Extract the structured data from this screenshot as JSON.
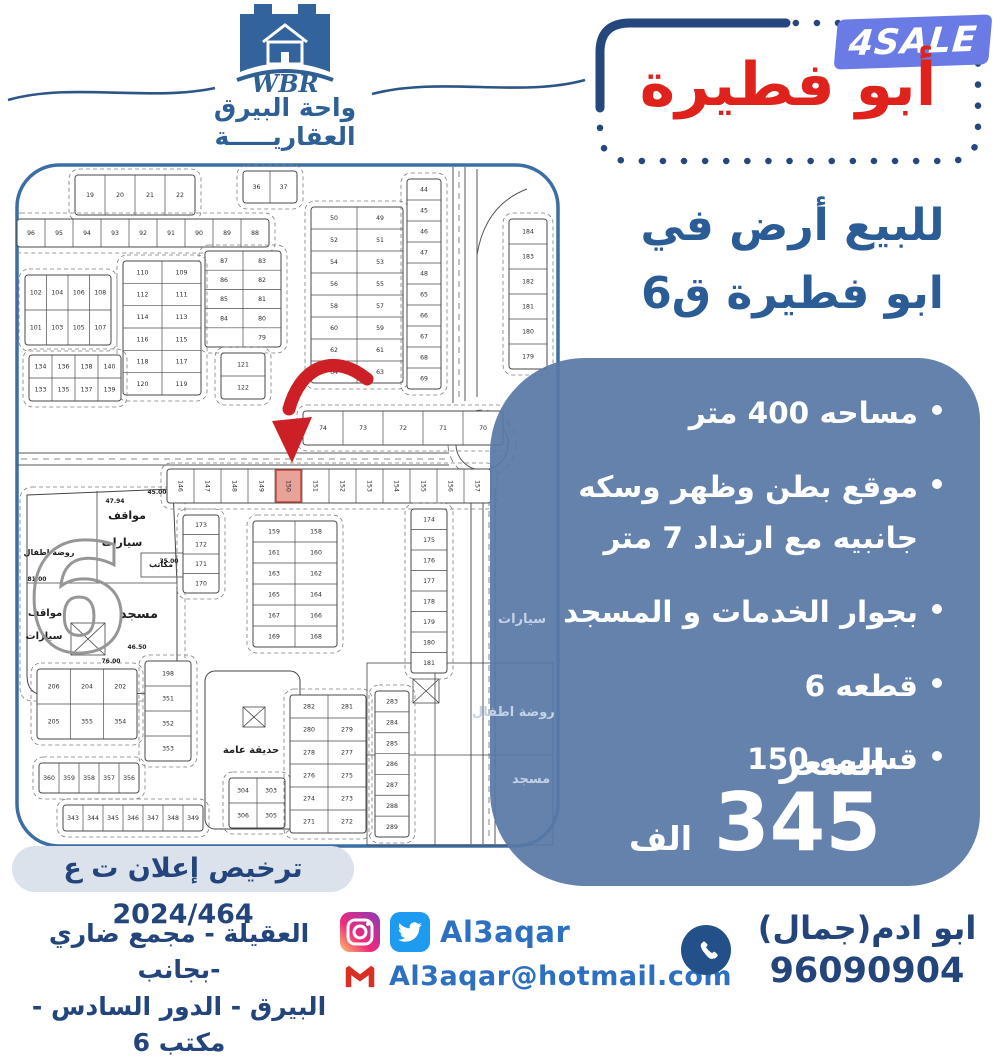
{
  "logo": {
    "wbr": "WBR",
    "line1": "واحة البيرق",
    "line2": "العقاريـــــة"
  },
  "badge": {
    "text": "4SALE"
  },
  "title": {
    "text": "أبو فطيرة"
  },
  "heading": {
    "line1": "للبيع أرض في",
    "line2": "ابو فطيرة ق6"
  },
  "details": {
    "bullets": [
      "مساحه 400 متر",
      "موقع بطن وظهر وسكه جانبيه مع ارتداد 7 متر",
      "بجوار الخدمات و المسجد",
      "قطعه 6",
      "قسيمه 150"
    ],
    "price_label": "السعر",
    "price_value": "345",
    "price_unit": "الف"
  },
  "license": {
    "text": "ترخيص إعلان ت ع 2024/464"
  },
  "footer": {
    "address1": "العقيلة - مجمع ضاري -بجانب",
    "address2": "البيرق - الدور السادس - مكتب 6",
    "handle": "Al3aqar",
    "email": "Al3aqar@hotmail.com",
    "agent": "ابو ادم(جمال)",
    "phone": "96090904"
  },
  "colors": {
    "navy": "#26477e",
    "red_title": "#df231c",
    "panel_blue": "#5879a6",
    "badge_bg": "#6a7be6",
    "link_blue": "#2d6fc0",
    "arrow_red": "#cc2026",
    "highlight_plot": "#e7a29a"
  },
  "map": {
    "highlight": "150",
    "blocks": [
      {
        "x": 60,
        "y": 12,
        "w": 120,
        "h": 40,
        "r": 1,
        "c": 4,
        "n": [
          "19",
          "20",
          "21",
          "22"
        ]
      },
      {
        "x": 2,
        "y": 56,
        "w": 252,
        "h": 28,
        "r": 1,
        "c": 9,
        "n": [
          "96",
          "95",
          "94",
          "93",
          "92",
          "91",
          "90",
          "89",
          "88"
        ]
      },
      {
        "x": 190,
        "y": 88,
        "w": 76,
        "h": 96,
        "r": 5,
        "c": 2,
        "n": [
          "87",
          "83",
          "86",
          "82",
          "85",
          "81",
          "84",
          "80",
          "",
          "79"
        ]
      },
      {
        "x": 228,
        "y": 8,
        "w": 54,
        "h": 32,
        "r": 1,
        "c": 2,
        "n": [
          "36",
          "37"
        ]
      },
      {
        "x": 10,
        "y": 112,
        "w": 86,
        "h": 70,
        "r": 2,
        "c": 4,
        "n": [
          "102",
          "104",
          "106",
          "108",
          "101",
          "103",
          "105",
          "107"
        ]
      },
      {
        "x": 108,
        "y": 98,
        "w": 78,
        "h": 134,
        "r": 6,
        "c": 2,
        "n": [
          "110",
          "109",
          "112",
          "111",
          "114",
          "113",
          "116",
          "115",
          "118",
          "117",
          "120",
          "119"
        ]
      },
      {
        "x": 206,
        "y": 190,
        "w": 44,
        "h": 46,
        "r": 2,
        "c": 1,
        "n": [
          "121",
          "122"
        ]
      },
      {
        "x": 14,
        "y": 192,
        "w": 92,
        "h": 46,
        "r": 2,
        "c": 4,
        "n": [
          "134",
          "136",
          "138",
          "140",
          "133",
          "135",
          "137",
          "139"
        ]
      },
      {
        "x": 296,
        "y": 44,
        "w": 92,
        "h": 176,
        "r": 8,
        "c": 2,
        "n": [
          "50",
          "49",
          "52",
          "51",
          "54",
          "53",
          "56",
          "55",
          "58",
          "57",
          "60",
          "59",
          "62",
          "61",
          "64",
          "63"
        ]
      },
      {
        "x": 392,
        "y": 16,
        "w": 34,
        "h": 210,
        "r": 10,
        "c": 1,
        "n": [
          "44",
          "45",
          "46",
          "47",
          "48",
          "65",
          "66",
          "67",
          "68",
          "69"
        ]
      },
      {
        "x": 494,
        "y": 56,
        "w": 38,
        "h": 150,
        "r": 6,
        "c": 1,
        "n": [
          "184",
          "183",
          "182",
          "181",
          "180",
          "179"
        ]
      },
      {
        "x": 288,
        "y": 248,
        "w": 200,
        "h": 34,
        "r": 1,
        "c": 5,
        "n": [
          "74",
          "73",
          "72",
          "71",
          "70"
        ]
      },
      {
        "x": 152,
        "y": 306,
        "w": 324,
        "h": 34,
        "r": 1,
        "c": 12,
        "rot": 1,
        "n": [
          "146",
          "147",
          "148",
          "149",
          "150",
          "151",
          "152",
          "153",
          "154",
          "155",
          "156",
          "157"
        ]
      },
      {
        "x": 168,
        "y": 352,
        "w": 36,
        "h": 78,
        "r": 4,
        "c": 1,
        "n": [
          "173",
          "172",
          "171",
          "170"
        ]
      },
      {
        "x": 238,
        "y": 358,
        "w": 84,
        "h": 126,
        "r": 6,
        "c": 2,
        "n": [
          "159",
          "158",
          "161",
          "160",
          "163",
          "162",
          "165",
          "164",
          "167",
          "166",
          "169",
          "168"
        ]
      },
      {
        "x": 22,
        "y": 506,
        "w": 100,
        "h": 70,
        "r": 2,
        "c": 3,
        "n": [
          "206",
          "204",
          "202",
          "205",
          "355",
          "354"
        ]
      },
      {
        "x": 130,
        "y": 498,
        "w": 46,
        "h": 100,
        "r": 4,
        "c": 1,
        "n": [
          "198",
          "351",
          "352",
          "353"
        ]
      },
      {
        "x": 24,
        "y": 600,
        "w": 100,
        "h": 30,
        "r": 1,
        "c": 5,
        "n": [
          "360",
          "359",
          "358",
          "357",
          "356"
        ]
      },
      {
        "x": 48,
        "y": 642,
        "w": 140,
        "h": 26,
        "r": 1,
        "c": 7,
        "n": [
          "343",
          "344",
          "345",
          "346",
          "347",
          "348",
          "349"
        ]
      },
      {
        "x": 214,
        "y": 615,
        "w": 56,
        "h": 50,
        "r": 2,
        "c": 2,
        "n": [
          "304",
          "303",
          "306",
          "305"
        ]
      },
      {
        "x": 275,
        "y": 532,
        "w": 76,
        "h": 138,
        "r": 6,
        "c": 2,
        "n": [
          "282",
          "281",
          "280",
          "279",
          "278",
          "277",
          "276",
          "275",
          "274",
          "273",
          "271",
          "272"
        ]
      },
      {
        "x": 360,
        "y": 528,
        "w": 34,
        "h": 146,
        "r": 7,
        "c": 1,
        "n": [
          "283",
          "284",
          "285",
          "286",
          "287",
          "288",
          "289"
        ]
      },
      {
        "x": 396,
        "y": 346,
        "w": 36,
        "h": 164,
        "r": 8,
        "c": 1,
        "n": [
          "174",
          "175",
          "176",
          "177",
          "178",
          "179",
          "180",
          "181"
        ]
      }
    ],
    "labels": [
      {
        "x": 112,
        "y": 356,
        "t": "مواقف",
        "s": 11
      },
      {
        "x": 107,
        "y": 383,
        "t": "سيارات",
        "s": 11
      },
      {
        "x": 34,
        "y": 392,
        "t": "روضة اطفال",
        "s": 8
      },
      {
        "x": 146,
        "y": 404,
        "t": "مكاتب",
        "s": 8
      },
      {
        "x": 124,
        "y": 455,
        "t": "مسجد",
        "s": 13
      },
      {
        "x": 30,
        "y": 453,
        "t": "مواقف",
        "s": 10
      },
      {
        "x": 29,
        "y": 476,
        "t": "سيارات",
        "s": 10
      },
      {
        "x": 236,
        "y": 590,
        "t": "حديقة عامة",
        "s": 10
      },
      {
        "x": 100,
        "y": 340,
        "t": "47.94",
        "s": 6
      },
      {
        "x": 142,
        "y": 331,
        "t": "45.00",
        "s": 6
      },
      {
        "x": 154,
        "y": 400,
        "t": "35.00",
        "s": 6
      },
      {
        "x": 22,
        "y": 418,
        "t": "81.00",
        "s": 6
      },
      {
        "x": 96,
        "y": 500,
        "t": "76.00",
        "s": 6
      },
      {
        "x": 122,
        "y": 486,
        "t": "46.50",
        "s": 6
      }
    ],
    "big_six": "6",
    "overlay_labels": [
      {
        "x": 528,
        "y": 612,
        "t": "سيارات"
      },
      {
        "x": 502,
        "y": 705,
        "t": "روضة اطفال"
      },
      {
        "x": 542,
        "y": 772,
        "t": "مسجد"
      }
    ]
  }
}
